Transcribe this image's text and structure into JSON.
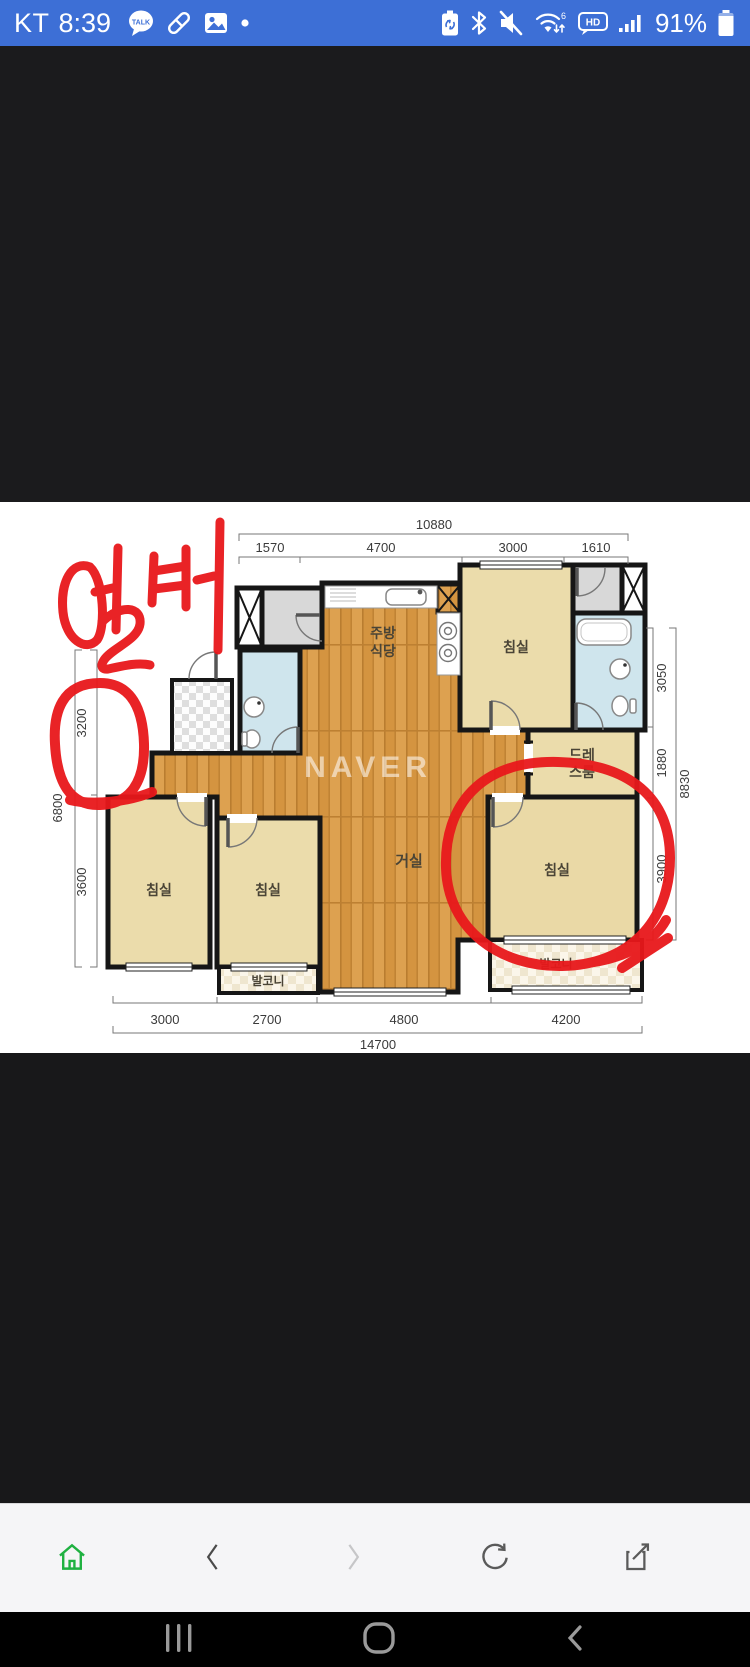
{
  "status_bar": {
    "carrier": "KT",
    "time": "8:39",
    "kakao_label": "TALK",
    "wifi_gen": "6",
    "hd_label": "HD",
    "battery_percent": "91%",
    "bg_color": "#3d6fd6",
    "left_icons": [
      "kakaotalk-icon",
      "pen-icon",
      "gallery-icon",
      "notification-dot-icon"
    ],
    "right_icons": [
      "battery-saver-icon",
      "bluetooth-icon",
      "mute-icon",
      "wifi-icon",
      "hd-icon",
      "signal-icon",
      "battery-icon"
    ]
  },
  "floorplan": {
    "watermark": "NAVER",
    "annotation": {
      "text": "엘베",
      "color": "#e8181b"
    },
    "rooms": {
      "kitchen_line1": "주방",
      "kitchen_line2": "식당",
      "living": "거실",
      "bedroom": "침실",
      "dress_line1": "드레",
      "dress_line2": "스룸",
      "balcony": "발코니"
    },
    "dims": {
      "top_total": "10880",
      "top_segments": [
        "1570",
        "4700",
        "3000",
        "1610"
      ],
      "left_total": "6800",
      "left_segments": [
        "3200",
        "3600"
      ],
      "right_total": "8830",
      "right_segments": [
        "3050",
        "1880",
        "3900"
      ],
      "bottom_total": "14700",
      "bottom_segments": [
        "3000",
        "2700",
        "4800",
        "4200"
      ]
    }
  },
  "browser_bar": {
    "icons": [
      "home-icon",
      "back-icon",
      "forward-icon",
      "refresh-icon",
      "share-icon"
    ],
    "home_color": "#1fb141"
  },
  "android_nav": {
    "icons": [
      "recents-icon",
      "home-icon",
      "back-icon"
    ]
  }
}
